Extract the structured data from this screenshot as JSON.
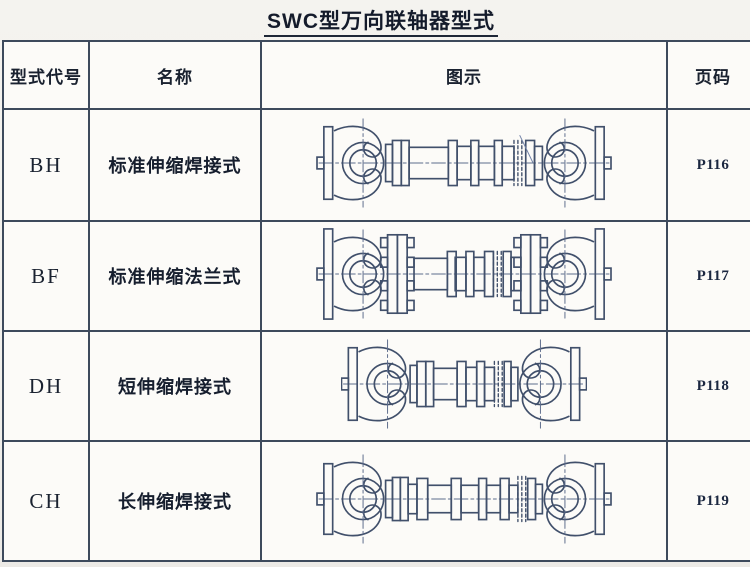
{
  "page": {
    "title": "SWC型万向联轴器型式"
  },
  "table": {
    "headers": {
      "code": "型式代号",
      "name": "名称",
      "diagram": "图示",
      "page": "页码"
    },
    "rows": [
      {
        "code": "BH",
        "name": "标准伸缩焊接式",
        "page": "P116",
        "drawing": "bh"
      },
      {
        "code": "BF",
        "name": "标准伸缩法兰式",
        "page": "P117",
        "drawing": "bf"
      },
      {
        "code": "DH",
        "name": "短伸缩焊接式",
        "page": "P118",
        "drawing": "dh"
      },
      {
        "code": "CH",
        "name": "长伸缩焊接式",
        "page": "P119",
        "drawing": "ch"
      }
    ],
    "colors": {
      "grid_line": "#3d4a5c",
      "drawing_line": "#41506b",
      "text": "#1a2230"
    }
  }
}
